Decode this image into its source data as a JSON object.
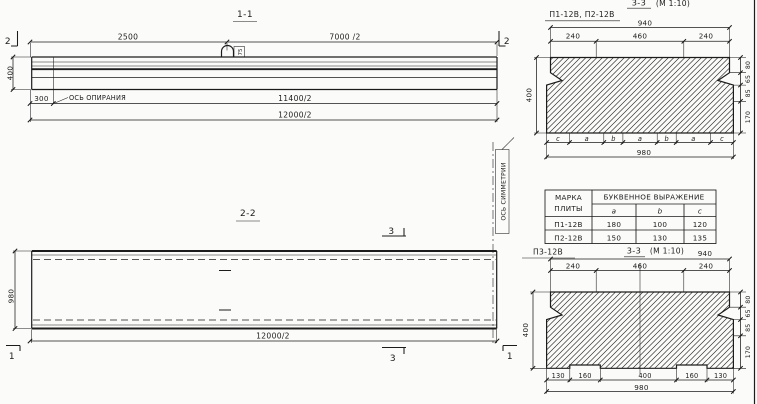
{
  "colors": {
    "ink": "#1c1c1c",
    "paper": "#fbfbfa"
  },
  "section_1_1": {
    "title": "1-1",
    "dim_2500": "2500",
    "dim_7000_2": "7000 /2",
    "dim_400": "400",
    "dim_300": "300",
    "dim_11400_2": "11400/2",
    "dim_12000_2": "12000/2",
    "support_axis_label": "ОСЬ ОПИРАНИЯ",
    "cut_mark_left": "2",
    "cut_mark_right": "2",
    "loop_tag": "75"
  },
  "section_2_2": {
    "title": "2-2",
    "dim_980": "980",
    "dim_12000_2": "12000/2",
    "cut_mark_3_top": "3",
    "cut_mark_3_bottom": "3",
    "cut_mark_1_left": "1",
    "cut_mark_1_right": "1",
    "symmetry_axis_label": "ОСЬ СИММЕТРИИ"
  },
  "section_3_3_top": {
    "plate_marks": "П1-12В, П2-12В",
    "title": "3-3",
    "scale": "(М 1:10)",
    "dim_940": "940",
    "dim_240_left": "240",
    "dim_460": "460",
    "dim_240_right": "240",
    "dim_400": "400",
    "dims_right": [
      "80",
      "65",
      "85",
      "170"
    ],
    "letters": [
      "c",
      "a",
      "b",
      "a",
      "b",
      "a",
      "c"
    ],
    "dim_980": "980"
  },
  "table": {
    "col1_line1": "МАРКА",
    "col1_line2": "ПЛИТЫ",
    "span_header": "БУКВЕННОЕ  ВЫРАЖЕНИЕ",
    "sub": {
      "a": "a",
      "b": "b",
      "c": "c"
    },
    "rows": [
      {
        "mark": "П1-12В",
        "a": "180",
        "b": "100",
        "c": "120"
      },
      {
        "mark": "П2-12В",
        "a": "150",
        "b": "130",
        "c": "135"
      }
    ]
  },
  "section_3_3_bottom": {
    "plate_mark": "П3-12В",
    "title": "3-3",
    "scale": "(М 1:10)",
    "dim_940": "940",
    "dim_240_left": "240",
    "dim_460": "460",
    "dim_240_right": "240",
    "dim_400": "400",
    "dims_right": [
      "80",
      "65",
      "85",
      "170"
    ],
    "dims_bottom": [
      "130",
      "160",
      "400",
      "160",
      "130"
    ],
    "dim_980": "980"
  }
}
